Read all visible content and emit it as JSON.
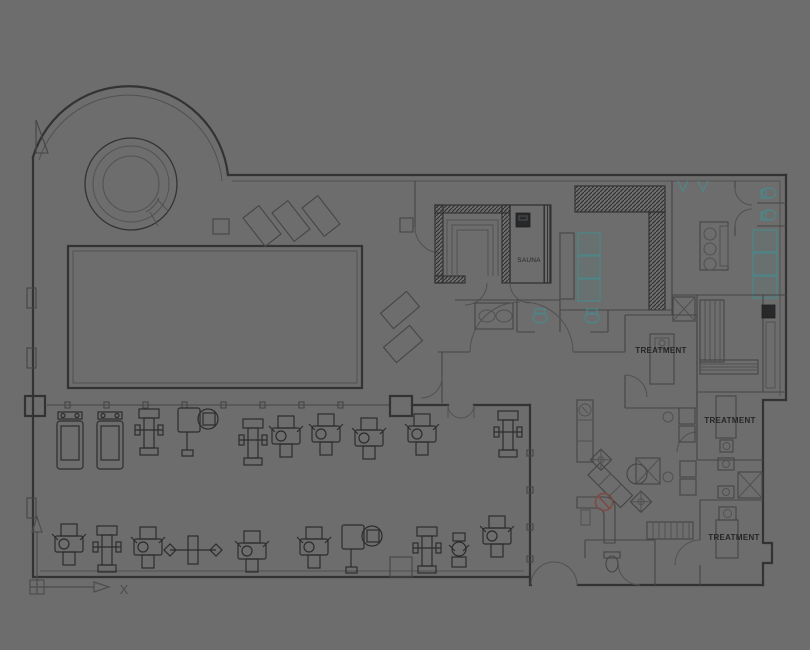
{
  "app": {
    "name": "cad-floor-plan-viewport",
    "description": "Health club and spa floor plan drawing: pool hall with whirlpool, sauna and steam rooms, changing rooms with lockers and WCs, three treatment rooms, gym with equipment, lounge and reception"
  },
  "colors": {
    "bg": "#6d6d6d",
    "wall": "#333333",
    "line": "#454545",
    "thin": "#515151",
    "dark": "#2c2c2c",
    "teal": "#4e8688",
    "red": "#7c4a40",
    "text": "#262626"
  },
  "labels": {
    "sauna": "SAUNA",
    "treatment_1": "TREATMENT",
    "treatment_2": "TREATMENT",
    "treatment_3": "TREATMENT",
    "ucs_x": "X"
  },
  "gym_equipment": [
    {
      "type": "treadmill",
      "x": 57,
      "y": 412
    },
    {
      "type": "treadmill",
      "x": 97,
      "y": 412
    },
    {
      "type": "weight-tower",
      "x": 139,
      "y": 409
    },
    {
      "type": "cable-machine",
      "x": 178,
      "y": 408
    },
    {
      "type": "weight-tower",
      "x": 243,
      "y": 419
    },
    {
      "type": "weight-machine",
      "x": 272,
      "y": 416
    },
    {
      "type": "weight-machine",
      "x": 312,
      "y": 414
    },
    {
      "type": "weight-machine",
      "x": 355,
      "y": 418
    },
    {
      "type": "weight-machine",
      "x": 408,
      "y": 414
    },
    {
      "type": "weight-tower",
      "x": 498,
      "y": 411
    },
    {
      "type": "weight-machine",
      "x": 55,
      "y": 524
    },
    {
      "type": "weight-tower",
      "x": 97,
      "y": 526
    },
    {
      "type": "weight-machine",
      "x": 134,
      "y": 527
    },
    {
      "type": "barbell-bench",
      "x": 170,
      "y": 534
    },
    {
      "type": "weight-machine",
      "x": 238,
      "y": 531
    },
    {
      "type": "weight-machine",
      "x": 300,
      "y": 527
    },
    {
      "type": "cable-machine",
      "x": 342,
      "y": 525
    },
    {
      "type": "weight-tower",
      "x": 417,
      "y": 527
    },
    {
      "type": "stepper",
      "x": 450,
      "y": 533
    },
    {
      "type": "weight-machine",
      "x": 483,
      "y": 516
    }
  ]
}
